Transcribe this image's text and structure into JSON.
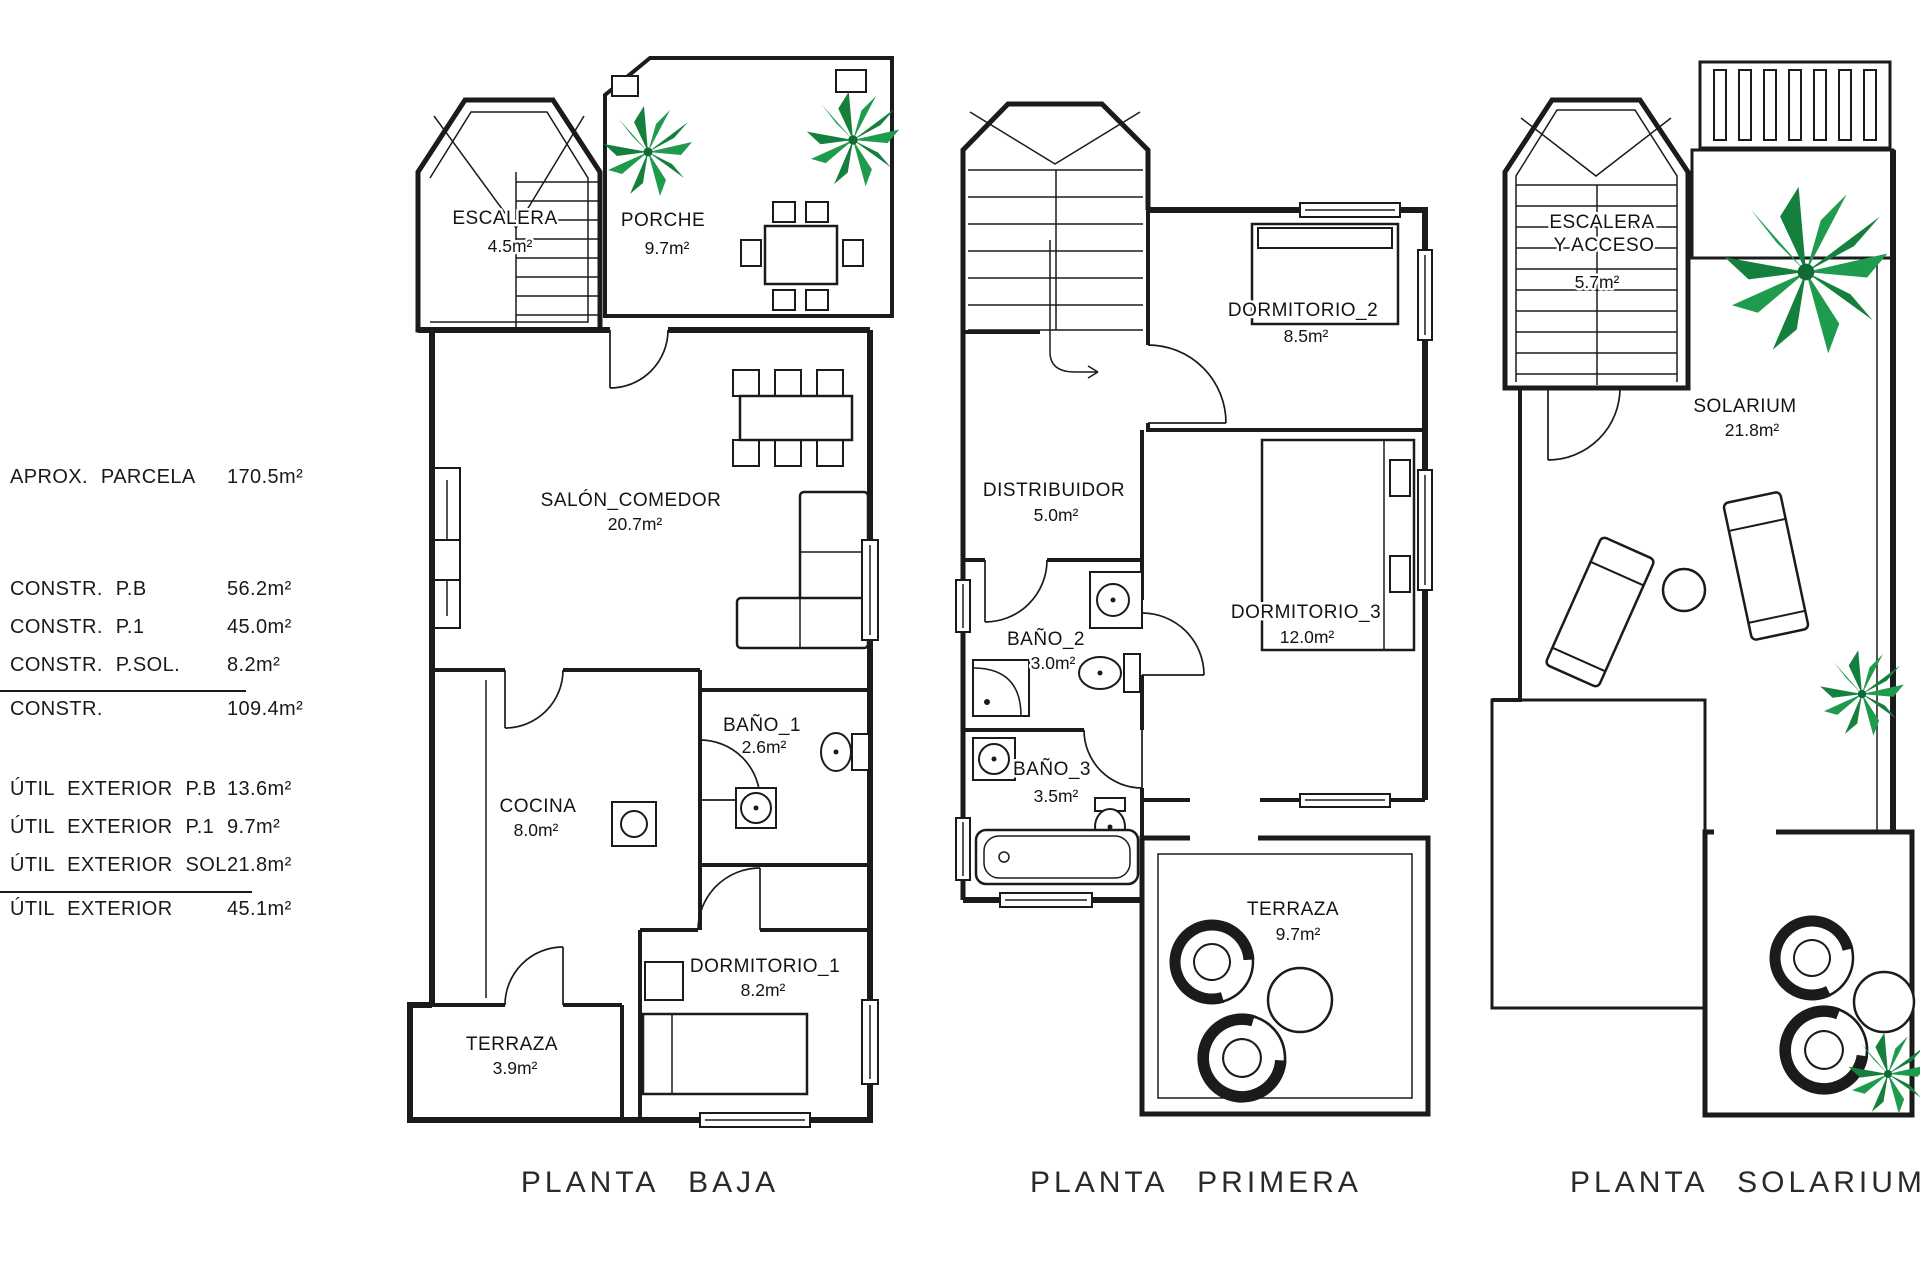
{
  "info_table": {
    "rows": [
      {
        "label": "APROX. PARCELA",
        "value": "170.5m²"
      },
      {
        "label": "CONSTR. P.B",
        "value": "56.2m²"
      },
      {
        "label": "CONSTR. P.1",
        "value": "45.0m²"
      },
      {
        "label": "CONSTR. P.SOL.",
        "value": "8.2m²"
      },
      {
        "label": "CONSTR.",
        "value": "109.4m²"
      },
      {
        "label": "ÚTIL EXTERIOR P.B",
        "value": "13.6m²"
      },
      {
        "label": "ÚTIL EXTERIOR P.1",
        "value": "9.7m²"
      },
      {
        "label": "ÚTIL EXTERIOR SOL.",
        "value": "21.8m²"
      },
      {
        "label": "ÚTIL EXTERIOR",
        "value": "45.1m²"
      }
    ]
  },
  "plans": {
    "baja": {
      "title": "PLANTA BAJA",
      "rooms": {
        "escalera": {
          "name": "ESCALERA",
          "area": "4.5m²"
        },
        "porche": {
          "name": "PORCHE",
          "area": "9.7m²"
        },
        "salon": {
          "name": "SALÓN_COMEDOR",
          "area": "20.7m²"
        },
        "bano1": {
          "name": "BAÑO_1",
          "area": "2.6m²"
        },
        "cocina": {
          "name": "COCINA",
          "area": "8.0m²"
        },
        "dormitorio1": {
          "name": "DORMITORIO_1",
          "area": "8.2m²"
        },
        "terraza": {
          "name": "TERRAZA",
          "area": "3.9m²"
        }
      }
    },
    "primera": {
      "title": "PLANTA PRIMERA",
      "rooms": {
        "dormitorio2": {
          "name": "DORMITORIO_2",
          "area": "8.5m²"
        },
        "distribuidor": {
          "name": "DISTRIBUIDOR",
          "area": "5.0m²"
        },
        "bano2": {
          "name": "BAÑO_2",
          "area": "3.0m²"
        },
        "dormitorio3": {
          "name": "DORMITORIO_3",
          "area": "12.0m²"
        },
        "bano3": {
          "name": "BAÑO_3",
          "area": "3.5m²"
        },
        "terraza": {
          "name": "TERRAZA",
          "area": "9.7m²"
        }
      }
    },
    "solarium": {
      "title": "PLANTA SOLARIUM",
      "rooms": {
        "escalera_acceso": {
          "name_line1": "ESCALERA",
          "name_line2": "Y ACCESO",
          "area": "5.7m²"
        },
        "solarium": {
          "name": "SOLARIUM",
          "area": "21.8m²"
        }
      }
    }
  },
  "colors": {
    "line": "#1b1b1b",
    "palm_green": "#1f9b4d",
    "palm_green_dark": "#15803d",
    "tile_gray": "#9a9a9a"
  }
}
